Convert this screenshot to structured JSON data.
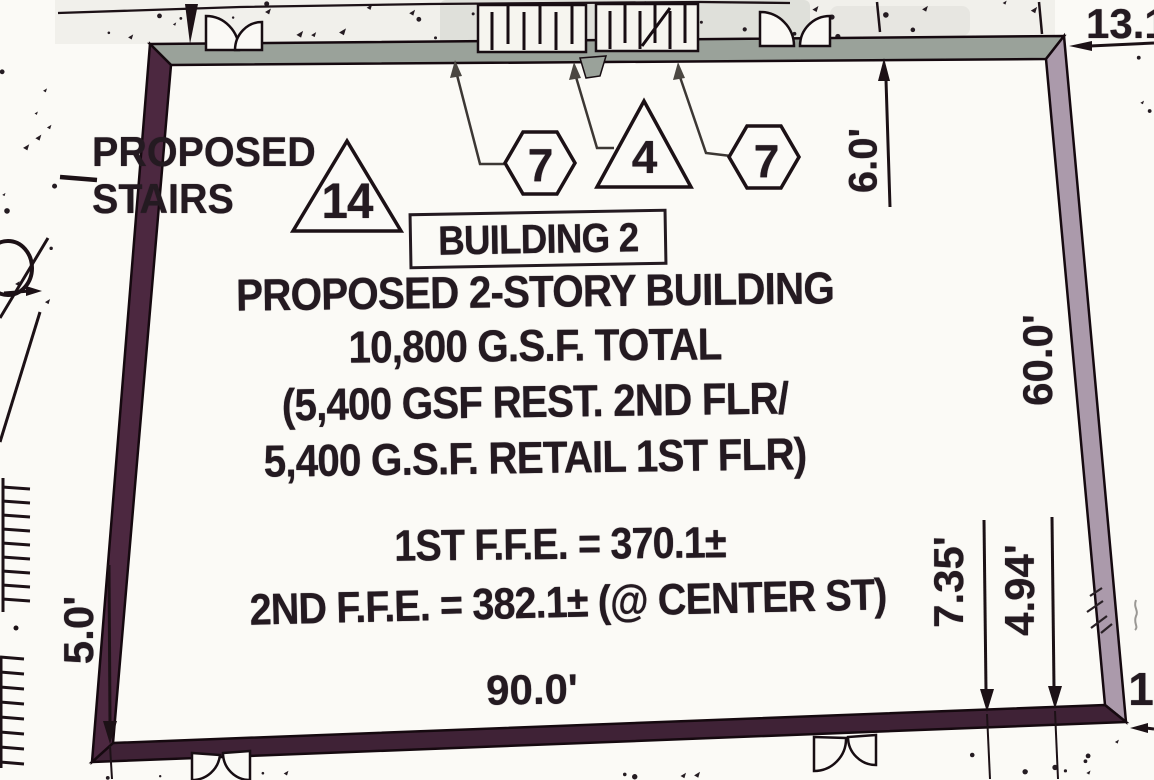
{
  "plan": {
    "stairs_label": {
      "line1": "PROPOSED",
      "line2": "STAIRS"
    },
    "building_tag": "BUILDING 2",
    "description": [
      "PROPOSED 2-STORY BUILDING",
      "10,800 G.S.F. TOTAL",
      "(5,400 GSF REST. 2ND FLR/",
      "5,400 G.S.F. RETAIL 1ST FLR)"
    ],
    "elevations": [
      "1ST F.F.E. = 370.1±",
      "2ND F.F.E. = 382.1± (@ CENTER ST)"
    ],
    "keynotes": [
      {
        "shape": "triangle",
        "value": "14"
      },
      {
        "shape": "hexagon",
        "value": "7"
      },
      {
        "shape": "triangle",
        "value": "4"
      },
      {
        "shape": "hexagon",
        "value": "7"
      }
    ],
    "dimensions": {
      "bottom_width": "90.0'",
      "left_offset": "5.0'",
      "top_right_offset": "6.0'",
      "right_depth": "60.0'",
      "right_lower_a": "7.35'",
      "right_lower_b": "4.94'",
      "top_right_corner": "13.16",
      "right_edge_partial": "1"
    },
    "colors": {
      "ink": "#241a21",
      "wall_top": "#9aa29a",
      "wall_right": "#ab9aab",
      "wall_bottom": "#3f2236",
      "wall_left": "#4c2840"
    }
  }
}
